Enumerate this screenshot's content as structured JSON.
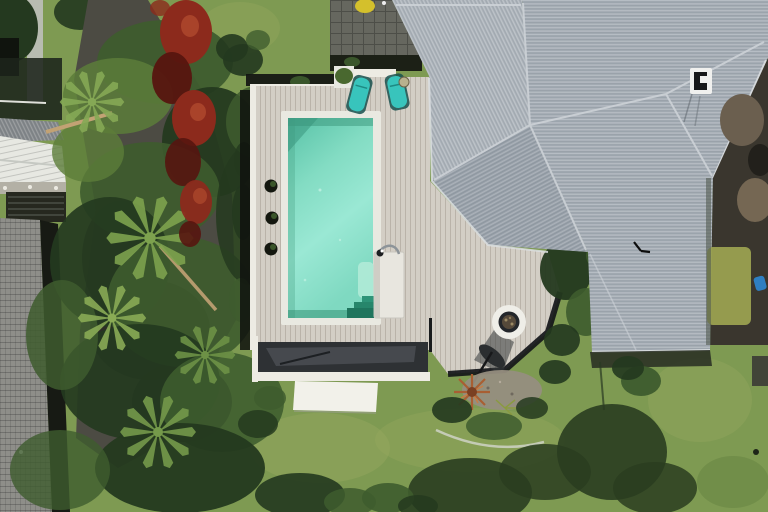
{
  "scene": {
    "type": "aerial-drone-photograph",
    "subject": "Backyard with rectangular swimming pool, timber deck, fire-pit octagon deck, gray metal hip roof house, gardens and lawn"
  },
  "colors": {
    "lawn_base": "#7e9a52",
    "lawn_light": "#97a85f",
    "lawn_dark": "#64823f",
    "shadow_green": "#2a3d20",
    "tree_dark": "#24391f",
    "tree_mid": "#3e5c2e",
    "tree_light": "#5c7d3a",
    "palm_frond": "#7da24e",
    "trunk": "#c2a274",
    "red_foliage": "#8c2a1c",
    "red_foliage_dark": "#57150f",
    "red_foliage_light": "#b04a2e",
    "asphalt": "#4c4b43",
    "asphalt_shadow": "#26261f",
    "concrete_path": "#b8bcb1",
    "shed_roof": "#e7e8e2",
    "metal_gray": "#84888b",
    "carport_dark": "#26281f",
    "wall_band": "#b3b0a5",
    "neighbor_roof": "#8e8e89",
    "fence_shadow": "#171a14",
    "deck_wood": "#d3cec5",
    "deck_white": "#edebe3",
    "pool_coping": "#e9e9e1",
    "pool_deep": "#58c2a7",
    "pool_shallow": "#a9ecd9",
    "pool_shadow": "#2f8e70",
    "step_unit": "#e8e6df",
    "step_dark": "#1f755d",
    "lounger_teal": "#38c4bc",
    "lounger_frame": "#17504e",
    "pot_black": "#14170f",
    "planter_white": "#e7e7e0",
    "plant_green": "#49682f",
    "dark_band": "#2e3134",
    "bench_gray": "#4a4e53",
    "pad_white": "#f2f1ea",
    "roof_light": "#aeb5bc",
    "roof_main": "#a5adb5",
    "roof_hip": "#9aa2ab",
    "roof_ridge": "#cdd2d7",
    "eave_white": "#dcdfe2",
    "vent_white": "#f0f0ee",
    "vent_black": "#17181a",
    "dirt_dark": "#3a362e",
    "dirt_brown": "#6b5f4f",
    "dirt_light": "#756753",
    "dirt_grass": "#9aa150",
    "blue_item": "#2e7fc2",
    "firepit_ring": "#efeee8",
    "firepit_bowl": "#23262a",
    "firepit_coals": "#55493a",
    "umbrella_dark": "#2b2e30",
    "bronze_plant": "#a85f33",
    "bronze_dark": "#7a3f22",
    "gravel": "#968e80",
    "curb_light": "#cfd2c6",
    "yellow_item": "#d4c02c",
    "paver_gray": "#66675f"
  }
}
